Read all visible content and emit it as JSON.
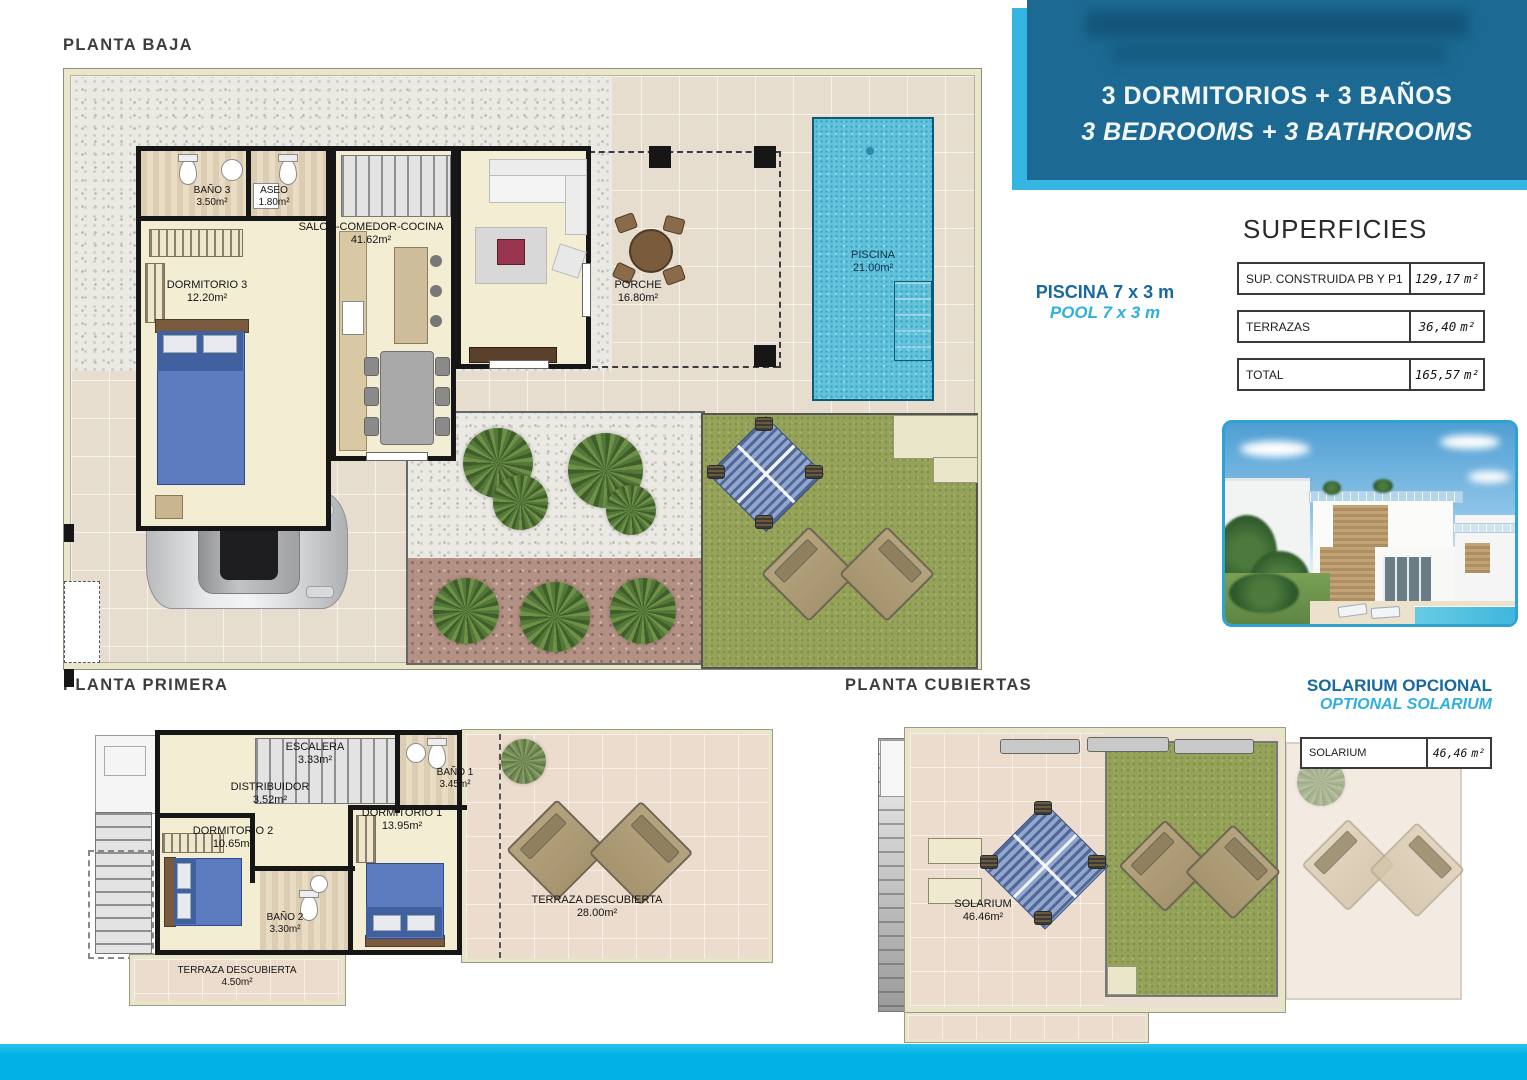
{
  "banner": {
    "line_es": "3 DORMITORIOS + 3 BAÑOS",
    "line_en": "3 BEDROOMS + 3 BATHROOMS"
  },
  "pool_note": {
    "es": "PISCINA 7 x 3 m",
    "en": "POOL 7 x 3 m"
  },
  "solarium_note": {
    "es": "SOLARIUM OPCIONAL",
    "en": "OPTIONAL SOLARIUM"
  },
  "superficies": {
    "title": "SUPERFICIES",
    "unit": "m²",
    "rows": [
      {
        "label": "SUP. CONSTRUIDA PB Y P1",
        "value": "129,17"
      },
      {
        "label": "TERRAZAS",
        "value": "36,40"
      },
      {
        "label": "TOTAL",
        "value": "165,57"
      }
    ]
  },
  "solarium_table": {
    "label": "SOLARIUM",
    "value": "46,46",
    "unit": "m²"
  },
  "plans": {
    "ground": {
      "title": "PLANTA BAJA",
      "rooms": {
        "bano3": {
          "name": "BAÑO 3",
          "area": "3.50m²"
        },
        "aseo": {
          "name": "ASEO",
          "area": "1.80m²"
        },
        "salon": {
          "name": "SALON-COMEDOR-COCINA",
          "area": "41.62m²"
        },
        "dormitorio3": {
          "name": "DORMITORIO 3",
          "area": "12.20m²"
        },
        "porche": {
          "name": "PORCHE",
          "area": "16.80m²"
        },
        "piscina": {
          "name": "PISCINA",
          "area": "21.00m²"
        }
      }
    },
    "first": {
      "title": "PLANTA PRIMERA",
      "rooms": {
        "escalera": {
          "name": "ESCALERA",
          "area": "3.33m²"
        },
        "distribuidor": {
          "name": "DISTRIBUIDOR",
          "area": "3.52m²"
        },
        "bano1": {
          "name": "BAÑO 1",
          "area": "3.45m²"
        },
        "dormitorio1": {
          "name": "DORMITORIO 1",
          "area": "13.95m²"
        },
        "dormitorio2": {
          "name": "DORMITORIO 2",
          "area": "10.65m²"
        },
        "bano2": {
          "name": "BAÑO 2",
          "area": "3.30m²"
        },
        "terraza_grande": {
          "name": "TERRAZA DESCUBIERTA",
          "area": "28.00m²"
        },
        "terraza_pequena": {
          "name": "TERRAZA DESCUBIERTA",
          "area": "4.50m²"
        }
      }
    },
    "roof": {
      "title": "PLANTA CUBIERTAS",
      "rooms": {
        "solarium": {
          "name": "SOLARIUM",
          "area": "46.46m²"
        }
      }
    }
  },
  "colors": {
    "banner_blue": "#1c6a93",
    "accent_cyan": "#00b2e6",
    "pool_blue": "#62c2dc",
    "grass_green": "#95a25a"
  }
}
